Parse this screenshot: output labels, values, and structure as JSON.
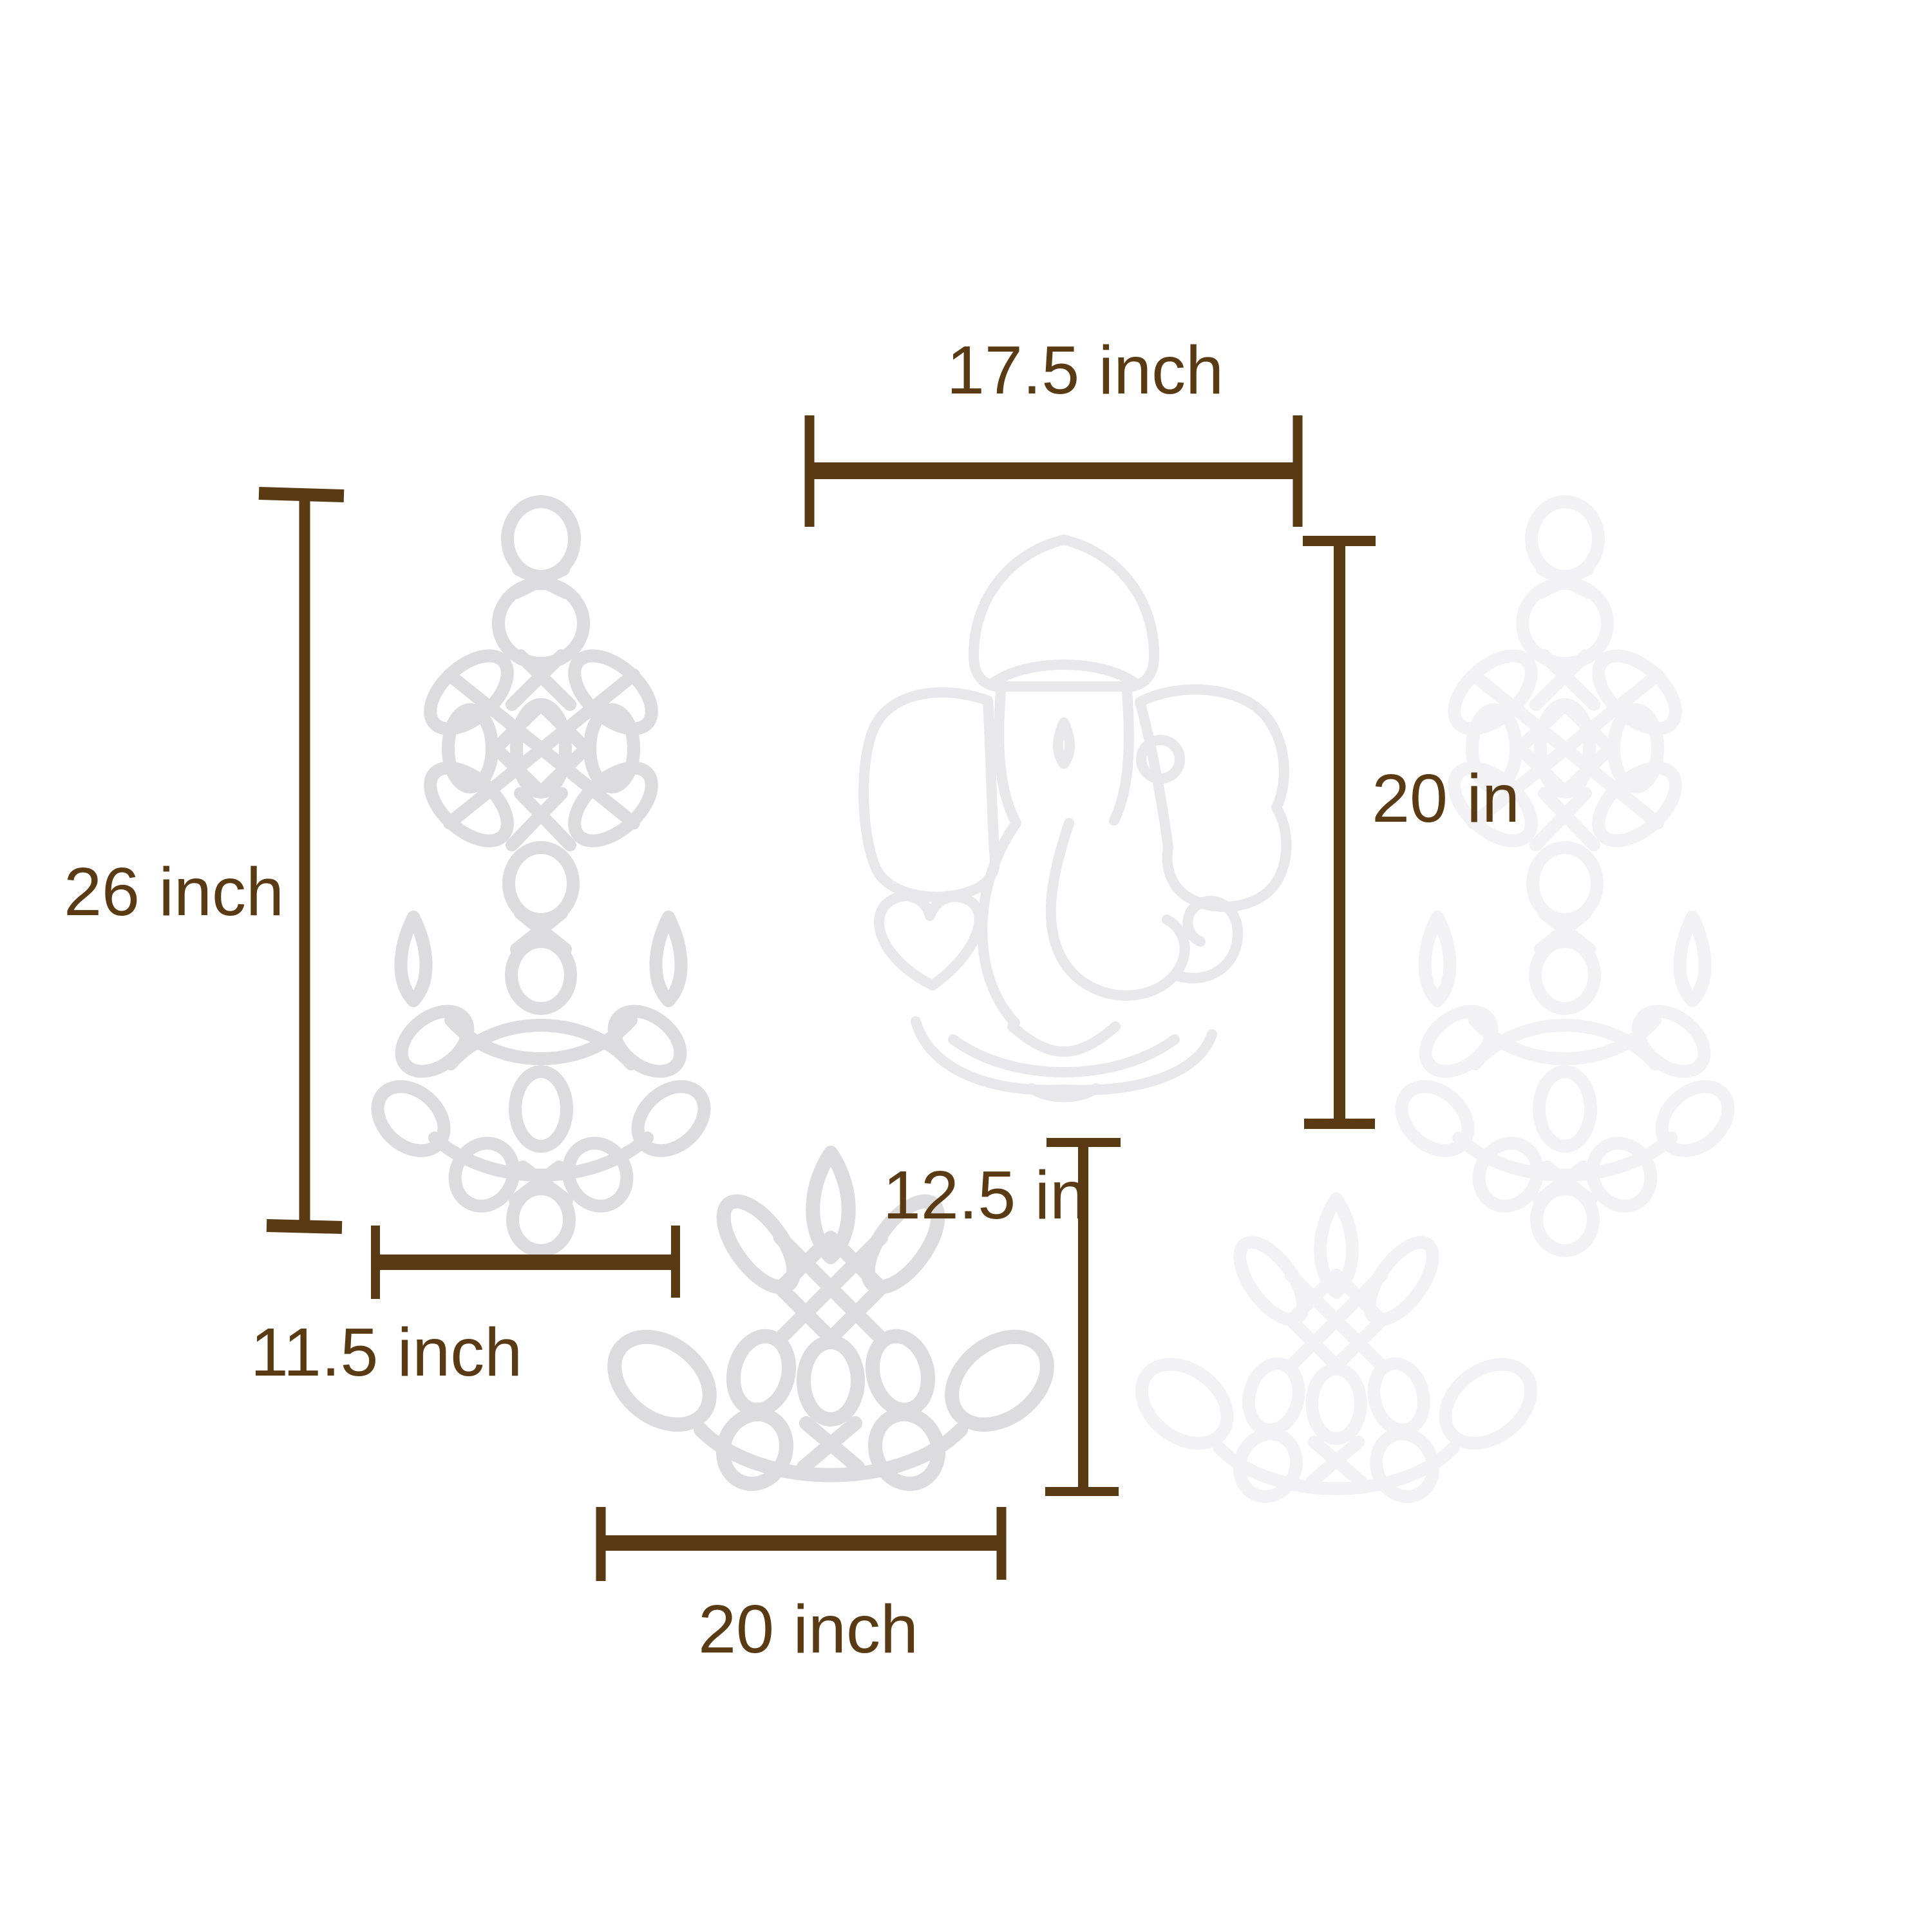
{
  "colors": {
    "background": "#ffffff",
    "dimension": "#5a3a12",
    "kolam": "#dcdcdf",
    "kolam-faint": "#f2f2f4",
    "ganesha": "#e8e8ea"
  },
  "labels": {
    "top_width": "17.5 inch",
    "left_height": "26 inch",
    "right_height": "20 in",
    "small_width": "11.5 inch",
    "lotus_height": "12.5 in",
    "lotus_width": "20 inch"
  },
  "designs": {
    "center": "ganesha-kolam-outline",
    "left": "lamp-chain-kolam",
    "right": "lamp-chain-kolam-faint",
    "bottom_center": "lotus-kolam",
    "bottom_right": "lotus-kolam-faint"
  }
}
